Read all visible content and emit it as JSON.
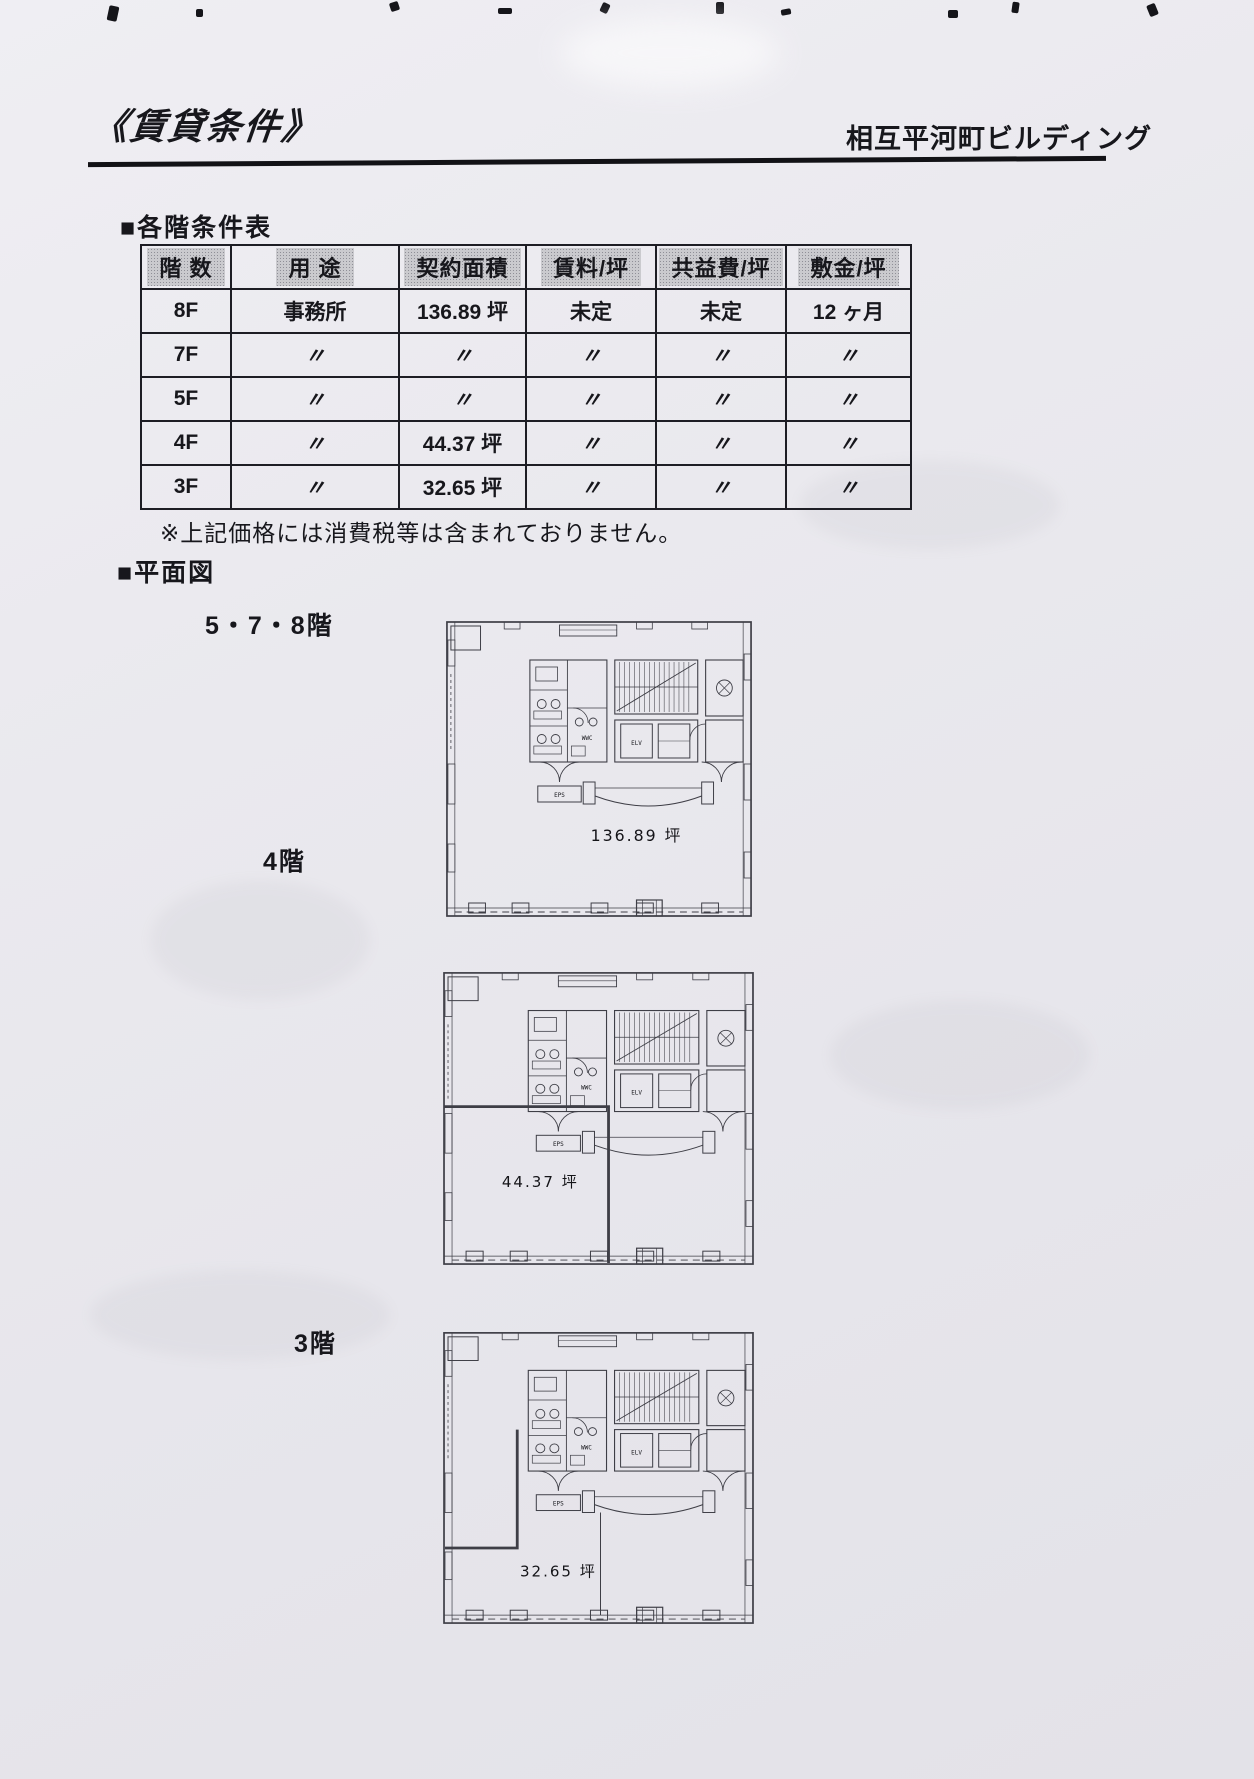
{
  "document": {
    "title": "《賃貸条件》",
    "building_name": "相互平河町ビルディング"
  },
  "conditions": {
    "heading": "■各階条件表",
    "table": {
      "headers": [
        "階 数",
        "用 途",
        "契約面積",
        "賃料/坪",
        "共益費/坪",
        "敷金/坪"
      ],
      "rows": [
        [
          "8F",
          "事務所",
          "136.89 坪",
          "未定",
          "未定",
          "12 ヶ月"
        ],
        [
          "7F",
          "〃",
          "〃",
          "〃",
          "〃",
          "〃"
        ],
        [
          "5F",
          "〃",
          "〃",
          "〃",
          "〃",
          "〃"
        ],
        [
          "4F",
          "〃",
          "44.37 坪",
          "〃",
          "〃",
          "〃"
        ],
        [
          "3F",
          "〃",
          "32.65 坪",
          "〃",
          "〃",
          "〃"
        ]
      ]
    },
    "note": "※上記価格には消費税等は含まれておりません。"
  },
  "floorplans": {
    "heading": "■平面図",
    "core_labels": {
      "wwc": "WWC",
      "elv": "ELV",
      "eps": "EPS"
    },
    "plans": [
      {
        "label": "5・7・8階",
        "area": "136.89 坪"
      },
      {
        "label": "4階",
        "area": "44.37 坪"
      },
      {
        "label": "3階",
        "area": "32.65 坪"
      }
    ]
  }
}
